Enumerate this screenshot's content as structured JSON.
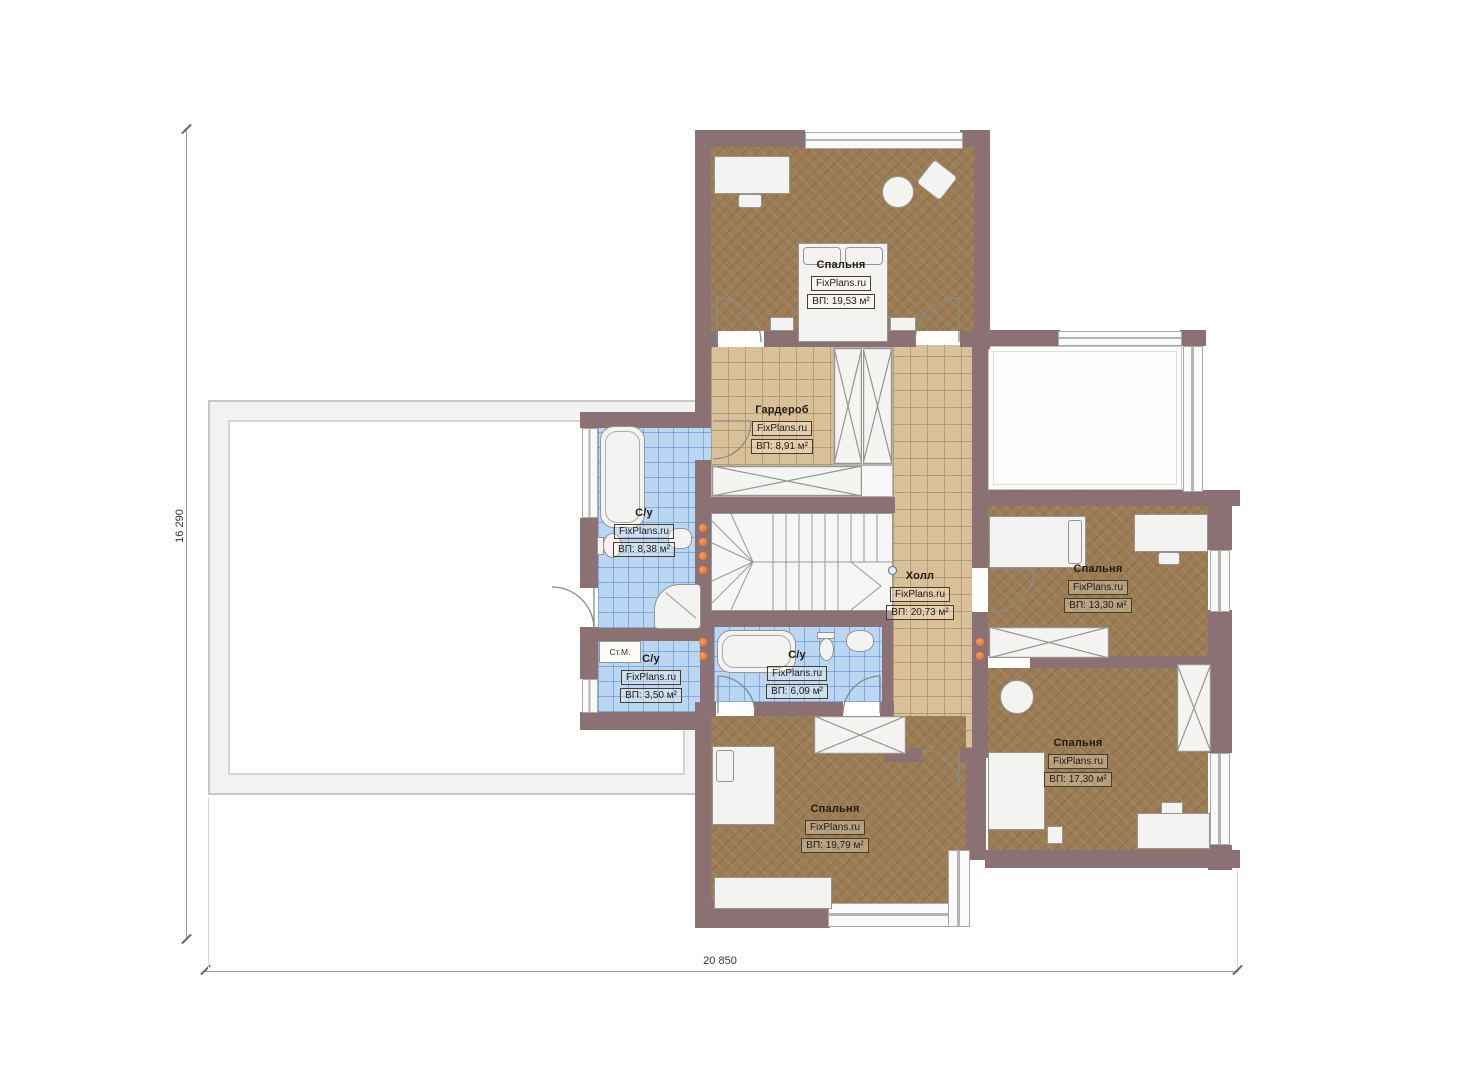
{
  "watermark": "FixPlans.ru",
  "rooms": [
    {
      "id": "bedroom-top",
      "name": "Спальня",
      "area": "ВП: 19,53 м²"
    },
    {
      "id": "wardrobe",
      "name": "Гардероб",
      "area": "ВП: 8,91 м²"
    },
    {
      "id": "bath-left",
      "name": "С/у",
      "area": "ВП: 8,38 м²"
    },
    {
      "id": "hall",
      "name": "Холл",
      "area": "ВП: 20,73 м²"
    },
    {
      "id": "bedroom-right",
      "name": "Спальня",
      "area": "ВП: 13,30 м²"
    },
    {
      "id": "bath-small",
      "name": "С/у",
      "area": "ВП: 3,50 м²"
    },
    {
      "id": "bath-middle",
      "name": "С/у",
      "area": "ВП: 6,09 м²"
    },
    {
      "id": "bedroom-bottom",
      "name": "Спальня",
      "area": "ВП: 19,79 м²"
    },
    {
      "id": "bedroom-bottom-right",
      "name": "Спальня",
      "area": "ВП: 17,30 м²"
    }
  ],
  "annotations": {
    "washing_machine": "Ст.М."
  },
  "dimensions": {
    "vertical": "16 290",
    "horizontal": "20 850"
  },
  "colors": {
    "wall": "#8b7173",
    "bedroom_floor": "#9a7d54",
    "tile_floor": "#d8c098",
    "bath_floor": "#b9d6f2",
    "radiator_marker": "#dd6a22",
    "stair_rail_dot": "#4a6fa5"
  }
}
